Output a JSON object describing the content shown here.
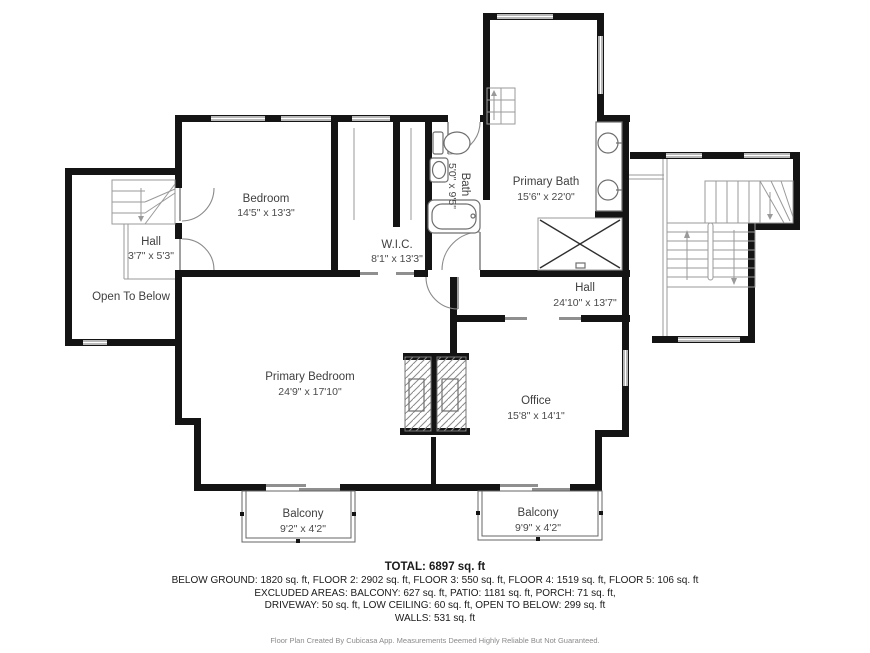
{
  "colors": {
    "wall": "#141414",
    "window_line": "#8f8f8f",
    "stair_line": "#9a9a9a",
    "fixture_line": "#6f6f6f",
    "label": "#3f3f3f",
    "background": "#ffffff"
  },
  "rooms": [
    {
      "name": "Bedroom",
      "dims": "14'5\" x 13'3\""
    },
    {
      "name": "W.I.C.",
      "dims": "8'1\" x 13'3\""
    },
    {
      "name": "Bath",
      "dims": "5'0\" x 9'5\""
    },
    {
      "name": "Primary Bath",
      "dims": "15'6\" x 22'0\""
    },
    {
      "name": "Hall",
      "dims": "3'7\" x 5'3\""
    },
    {
      "name": "Open To Below",
      "dims": ""
    },
    {
      "name": "Hall",
      "dims": "24'10\" x 13'7\""
    },
    {
      "name": "Primary Bedroom",
      "dims": "24'9\" x 17'10\""
    },
    {
      "name": "Office",
      "dims": "15'8\" x 14'1\""
    },
    {
      "name": "Balcony",
      "dims": "9'2\" x 4'2\""
    },
    {
      "name": "Balcony",
      "dims": "9'9\" x 4'2\""
    }
  ],
  "footer": {
    "total": "TOTAL: 6897 sq. ft",
    "line1": "BELOW GROUND: 1820 sq. ft, FLOOR 2: 2902 sq. ft, FLOOR 3: 550 sq. ft, FLOOR 4: 1519 sq. ft, FLOOR 5: 106 sq. ft",
    "line2": "EXCLUDED AREAS: BALCONY: 627 sq. ft, PATIO: 1181 sq. ft, PORCH: 71 sq. ft,",
    "line3": "DRIVEWAY: 50 sq. ft, LOW CEILING: 60 sq. ft, OPEN TO BELOW: 299 sq. ft",
    "line4": "WALLS: 531 sq. ft",
    "disclaimer": "Floor Plan Created By Cubicasa App. Measurements Deemed Highly Reliable But Not Guaranteed."
  }
}
